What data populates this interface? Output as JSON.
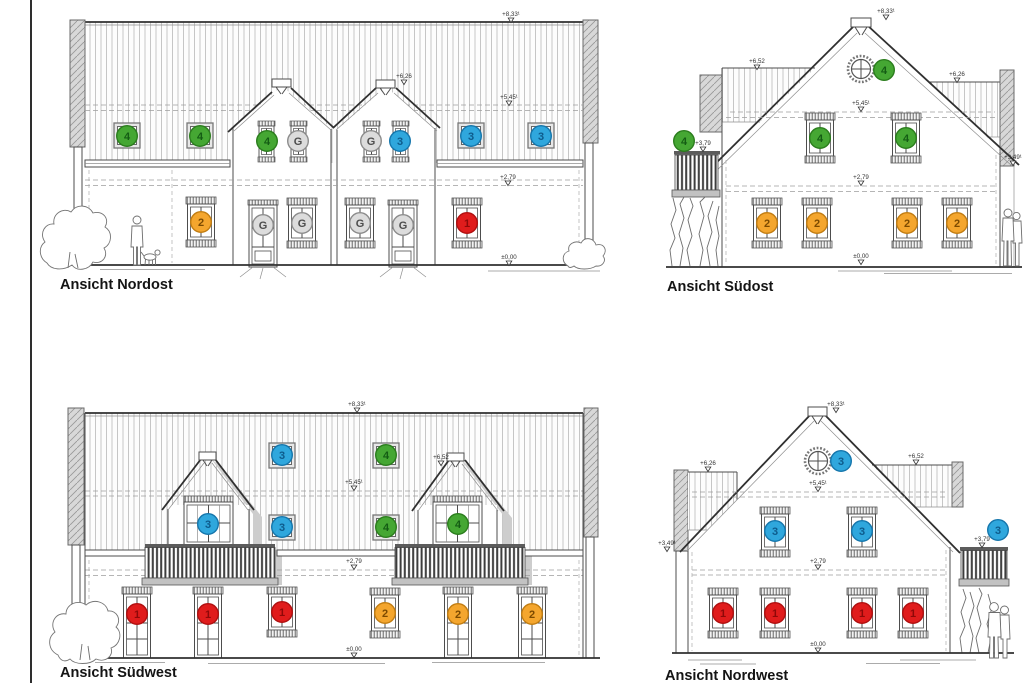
{
  "sheet": {
    "background": "#ffffff",
    "edge_line_color": "#2e2e2e"
  },
  "panels": {
    "nordost": {
      "label": "Ansicht Nordost"
    },
    "suedost": {
      "label": "Ansicht Südost"
    },
    "suedwest": {
      "label": "Ansicht Südwest"
    },
    "nordwest": {
      "label": "Ansicht Nordwest"
    }
  },
  "marker_styles": {
    "1": {
      "fill": "#e01c1c",
      "stroke": "#b01010",
      "text": "#8f0808"
    },
    "2": {
      "fill": "#f4a62e",
      "stroke": "#c27d12",
      "text": "#7c4a00"
    },
    "3": {
      "fill": "#2fa7dd",
      "stroke": "#1576ac",
      "text": "#0e5c8d"
    },
    "4": {
      "fill": "#45a733",
      "stroke": "#2b7d1d",
      "text": "#145c14"
    },
    "G": {
      "fill": "#dcdcdc",
      "stroke": "#8c8c8c",
      "text": "#4d4d4d"
    }
  },
  "markers": [
    {
      "panel": "nordost",
      "label": "4",
      "x": 127,
      "y": 136
    },
    {
      "panel": "nordost",
      "label": "4",
      "x": 200,
      "y": 136
    },
    {
      "panel": "nordost",
      "label": "4",
      "x": 267,
      "y": 141
    },
    {
      "panel": "nordost",
      "label": "G",
      "x": 298,
      "y": 141
    },
    {
      "panel": "nordost",
      "label": "G",
      "x": 371,
      "y": 141
    },
    {
      "panel": "nordost",
      "label": "3",
      "x": 400,
      "y": 141
    },
    {
      "panel": "nordost",
      "label": "3",
      "x": 471,
      "y": 136
    },
    {
      "panel": "nordost",
      "label": "3",
      "x": 541,
      "y": 136
    },
    {
      "panel": "nordost",
      "label": "2",
      "x": 201,
      "y": 222
    },
    {
      "panel": "nordost",
      "label": "G",
      "x": 263,
      "y": 225
    },
    {
      "panel": "nordost",
      "label": "G",
      "x": 302,
      "y": 223
    },
    {
      "panel": "nordost",
      "label": "G",
      "x": 360,
      "y": 223
    },
    {
      "panel": "nordost",
      "label": "G",
      "x": 403,
      "y": 225
    },
    {
      "panel": "nordost",
      "label": "1",
      "x": 467,
      "y": 223
    },
    {
      "panel": "suedost",
      "label": "4",
      "x": 884,
      "y": 70
    },
    {
      "panel": "suedost",
      "label": "4",
      "x": 684,
      "y": 141
    },
    {
      "panel": "suedost",
      "label": "4",
      "x": 820,
      "y": 138
    },
    {
      "panel": "suedost",
      "label": "4",
      "x": 906,
      "y": 138
    },
    {
      "panel": "suedost",
      "label": "2",
      "x": 767,
      "y": 223
    },
    {
      "panel": "suedost",
      "label": "2",
      "x": 817,
      "y": 223
    },
    {
      "panel": "suedost",
      "label": "2",
      "x": 907,
      "y": 223
    },
    {
      "panel": "suedost",
      "label": "2",
      "x": 957,
      "y": 223
    },
    {
      "panel": "suedwest",
      "label": "3",
      "x": 282,
      "y": 455
    },
    {
      "panel": "suedwest",
      "label": "4",
      "x": 386,
      "y": 455
    },
    {
      "panel": "suedwest",
      "label": "3",
      "x": 208,
      "y": 524
    },
    {
      "panel": "suedwest",
      "label": "3",
      "x": 282,
      "y": 527
    },
    {
      "panel": "suedwest",
      "label": "4",
      "x": 386,
      "y": 527
    },
    {
      "panel": "suedwest",
      "label": "4",
      "x": 458,
      "y": 524
    },
    {
      "panel": "suedwest",
      "label": "1",
      "x": 137,
      "y": 614
    },
    {
      "panel": "suedwest",
      "label": "1",
      "x": 208,
      "y": 614
    },
    {
      "panel": "suedwest",
      "label": "1",
      "x": 282,
      "y": 612
    },
    {
      "panel": "suedwest",
      "label": "2",
      "x": 385,
      "y": 613
    },
    {
      "panel": "suedwest",
      "label": "2",
      "x": 458,
      "y": 614
    },
    {
      "panel": "suedwest",
      "label": "2",
      "x": 532,
      "y": 614
    },
    {
      "panel": "nordwest",
      "label": "3",
      "x": 841,
      "y": 461
    },
    {
      "panel": "nordwest",
      "label": "3",
      "x": 775,
      "y": 531
    },
    {
      "panel": "nordwest",
      "label": "3",
      "x": 862,
      "y": 531
    },
    {
      "panel": "nordwest",
      "label": "3",
      "x": 998,
      "y": 530
    },
    {
      "panel": "nordwest",
      "label": "1",
      "x": 723,
      "y": 613
    },
    {
      "panel": "nordwest",
      "label": "1",
      "x": 775,
      "y": 613
    },
    {
      "panel": "nordwest",
      "label": "1",
      "x": 862,
      "y": 613
    },
    {
      "panel": "nordwest",
      "label": "1",
      "x": 913,
      "y": 613
    }
  ],
  "levels": [
    {
      "panel": "nordost",
      "text": "+8,33¹",
      "x": 511,
      "y": 16
    },
    {
      "panel": "nordost",
      "text": "+6,26",
      "x": 404,
      "y": 78
    },
    {
      "panel": "nordost",
      "text": "+5,45¹",
      "x": 509,
      "y": 99
    },
    {
      "panel": "nordost",
      "text": "+2,79",
      "x": 508,
      "y": 179
    },
    {
      "panel": "nordost",
      "text": "±0,00",
      "x": 509,
      "y": 259
    },
    {
      "panel": "suedost",
      "text": "+8,33¹",
      "x": 886,
      "y": 13
    },
    {
      "panel": "suedost",
      "text": "+6,52",
      "x": 757,
      "y": 63
    },
    {
      "panel": "suedost",
      "text": "+6,26",
      "x": 957,
      "y": 76
    },
    {
      "panel": "suedost",
      "text": "+5,45¹",
      "x": 861,
      "y": 105
    },
    {
      "panel": "suedost",
      "text": "+3,79",
      "x": 703,
      "y": 145
    },
    {
      "panel": "suedost",
      "text": "+3,49¹",
      "x": 1013,
      "y": 159
    },
    {
      "panel": "suedost",
      "text": "+2,79",
      "x": 861,
      "y": 179
    },
    {
      "panel": "suedost",
      "text": "±0,00",
      "x": 861,
      "y": 258
    },
    {
      "panel": "suedwest",
      "text": "+8,33¹",
      "x": 357,
      "y": 406
    },
    {
      "panel": "suedwest",
      "text": "+6,52",
      "x": 441,
      "y": 459
    },
    {
      "panel": "suedwest",
      "text": "+5,45¹",
      "x": 354,
      "y": 484
    },
    {
      "panel": "suedwest",
      "text": "+2,79",
      "x": 354,
      "y": 563
    },
    {
      "panel": "suedwest",
      "text": "±0,00",
      "x": 354,
      "y": 651
    },
    {
      "panel": "nordwest",
      "text": "+8,33¹",
      "x": 836,
      "y": 406
    },
    {
      "panel": "nordwest",
      "text": "+6,26",
      "x": 708,
      "y": 465
    },
    {
      "panel": "nordwest",
      "text": "+6,52",
      "x": 916,
      "y": 458
    },
    {
      "panel": "nordwest",
      "text": "+5,45¹",
      "x": 818,
      "y": 485
    },
    {
      "panel": "nordwest",
      "text": "+3,79",
      "x": 982,
      "y": 541
    },
    {
      "panel": "nordwest",
      "text": "+3,49¹",
      "x": 667,
      "y": 545
    },
    {
      "panel": "nordwest",
      "text": "+2,79",
      "x": 818,
      "y": 563
    },
    {
      "panel": "nordwest",
      "text": "±0,00",
      "x": 818,
      "y": 646
    }
  ]
}
